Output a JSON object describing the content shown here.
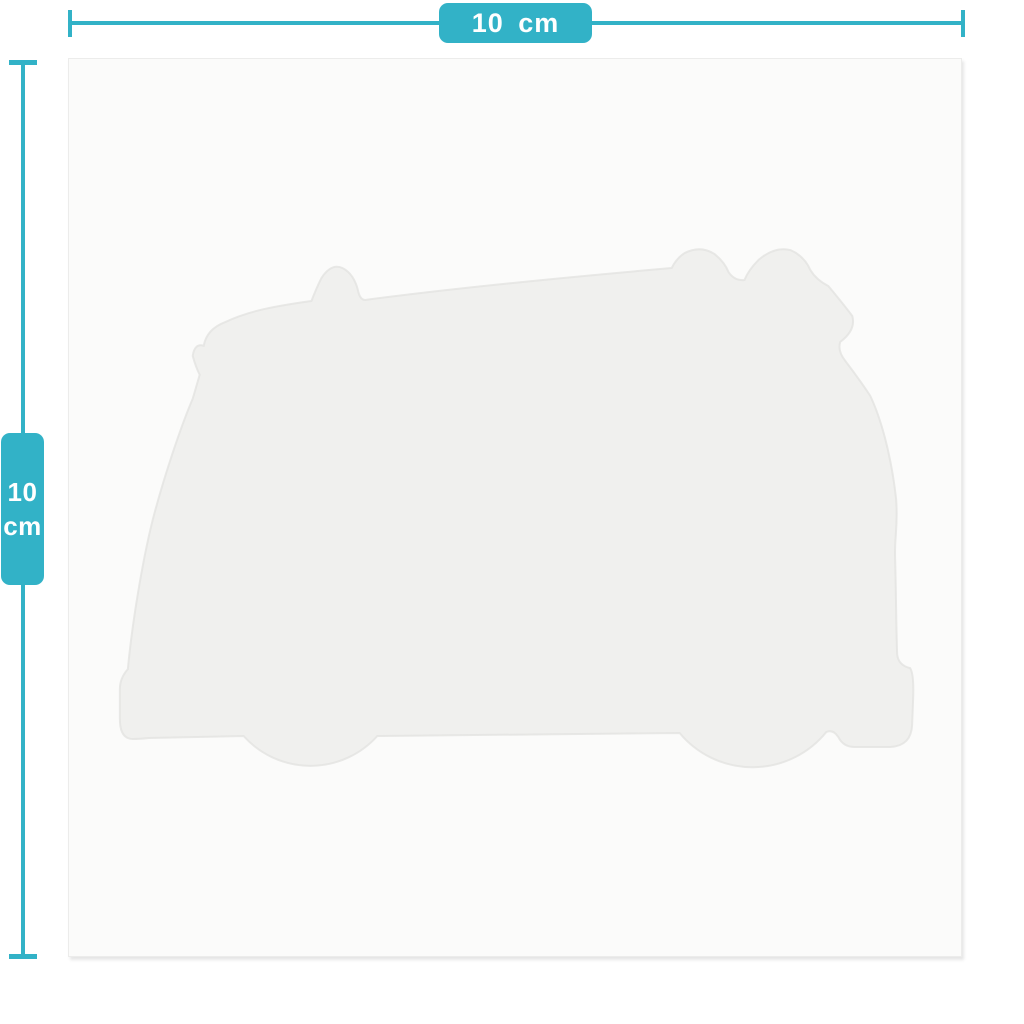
{
  "dimensions": {
    "width": {
      "label": "10 cm"
    },
    "height": {
      "value": "10",
      "unit": "cm"
    }
  },
  "silhouette": {
    "icon": "campervan-with-surfboard-silhouette",
    "description": "die-cut camper van side profile"
  },
  "colors": {
    "accent": "#32b2c7",
    "accent-text": "#ffffff",
    "page-bg": "#ffffff",
    "canvas-bg": "#fbfbfa",
    "canvas-border": "#ececeb",
    "silhouette-fill": "#f0f0ee",
    "silhouette-stroke": "#e4e4e2"
  }
}
